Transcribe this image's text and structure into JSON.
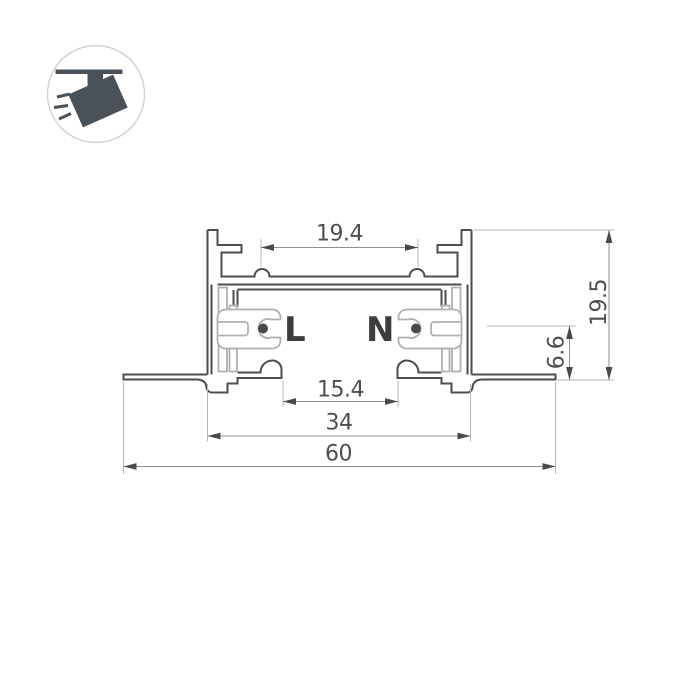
{
  "page": {
    "background_color": "#ffffff"
  },
  "badge": {
    "icon": "track-spotlight-icon"
  },
  "drawing": {
    "conductors": {
      "live_label": "L",
      "neutral_label": "N"
    },
    "dimensions": {
      "top_slot_width": "19.4",
      "overall_height": "19.5",
      "conductor_center_height": "6.6",
      "bottom_opening_width": "15.4",
      "housing_width": "34",
      "overall_width": "60"
    },
    "colors": {
      "profile_outline": "#4d4d4d",
      "insulator_outline": "#b0b0b0",
      "dimension_line": "#8f8f8f",
      "extension_line": "#b5b5b5",
      "dimension_text": "#4f4f4f",
      "conductor_text": "#3d3d3d",
      "icon_color": "#4a5158",
      "badge_border": "#d2d2d2"
    }
  }
}
